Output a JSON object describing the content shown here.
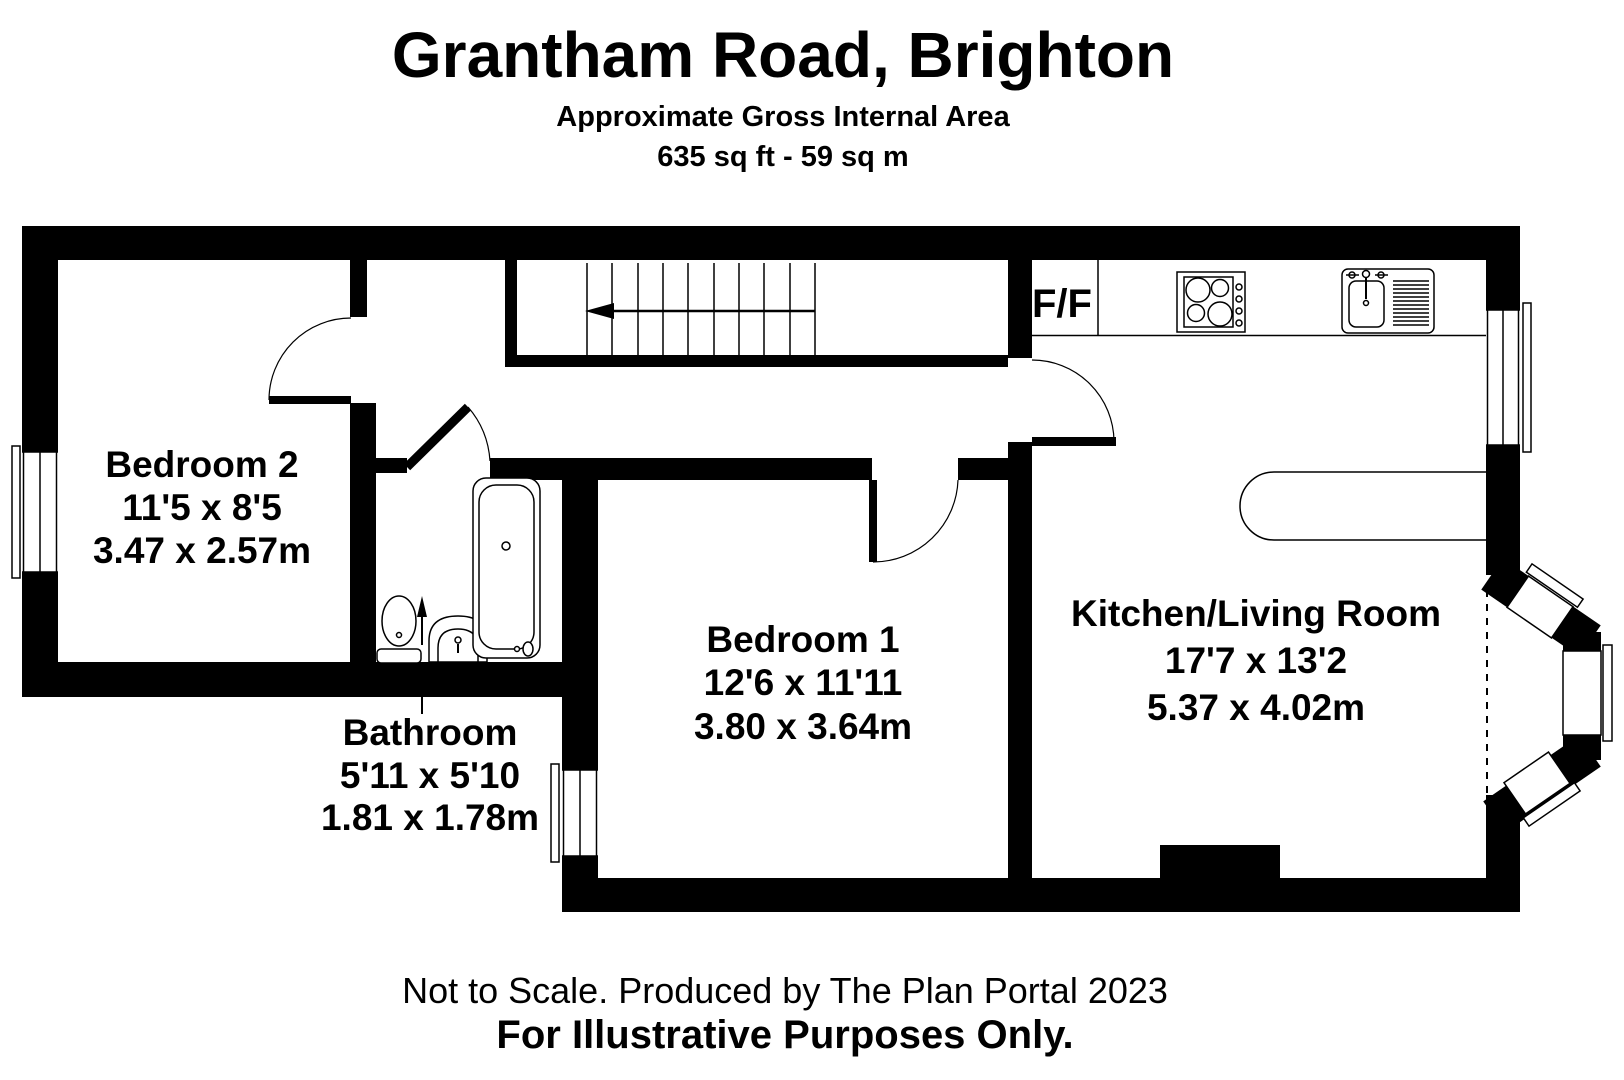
{
  "title": {
    "line1": "Grantham Road, Brighton",
    "line2": "Approximate Gross Internal Area",
    "line3": "635 sq ft - 59 sq m"
  },
  "rooms": {
    "bedroom2": {
      "name": "Bedroom 2",
      "imperial": "11'5 x 8'5",
      "metric": "3.47 x 2.57m"
    },
    "bathroom": {
      "name": "Bathroom",
      "imperial": "5'11 x 5'10",
      "metric": "1.81 x 1.78m"
    },
    "bedroom1": {
      "name": "Bedroom 1",
      "imperial": "12'6 x 11'11",
      "metric": "3.80 x 3.64m"
    },
    "kitchen_living": {
      "name": "Kitchen/Living Room",
      "imperial": "17'7 x 13'2",
      "metric": "5.37 x 4.02m"
    }
  },
  "labels": {
    "fridge_freezer": "F/F"
  },
  "footer": {
    "line1": "Not to Scale. Produced by The Plan Portal 2023",
    "line2": "For Illustrative Purposes Only."
  },
  "colors": {
    "wall": "#000000",
    "background": "#ffffff"
  }
}
